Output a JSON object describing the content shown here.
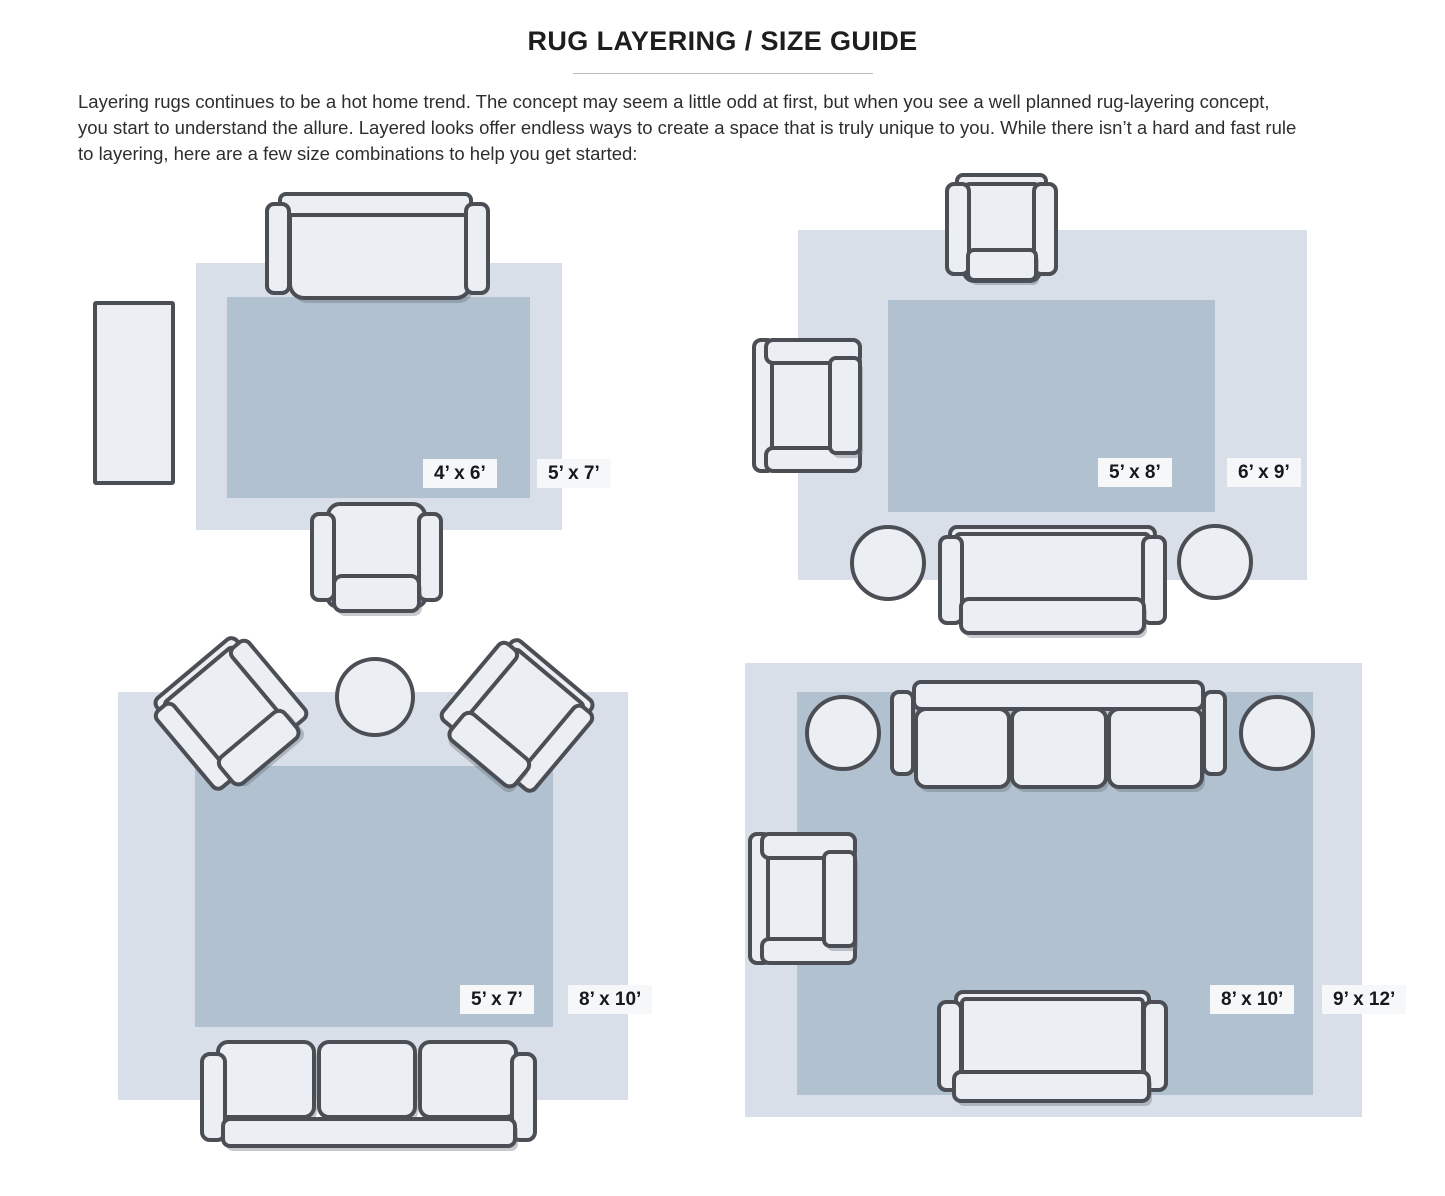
{
  "header": {
    "title": "RUG LAYERING / SIZE GUIDE",
    "intro_lines": [
      "Layering rugs continues to be a hot home trend. The concept may seem a little odd at first, but when you see a well planned rug-layering concept,",
      "you start to understand the allure. Layered looks offer endless ways to create a space that is truly unique to you. While there isn’t a hard and fast rule",
      "to layering, here are a few size combinations to help you get started:"
    ]
  },
  "colors": {
    "rug_outer": "#d9dfe8",
    "rug_inner": "#b2c1d0",
    "furniture_fill": "#ebeef2",
    "furniture_outline": "#4b4f55",
    "label_bg": "#f6f7f9",
    "label_text": "#17181a"
  },
  "diagrams": [
    {
      "id": "top-left",
      "inner_size": "4’ x 6’",
      "outer_size": "5’ x 7’"
    },
    {
      "id": "top-right",
      "inner_size": "5’ x 8’",
      "outer_size": "6’ x 9’"
    },
    {
      "id": "bottom-left",
      "inner_size": "5’ x 7’",
      "outer_size": "8’ x 10’"
    },
    {
      "id": "bottom-right",
      "inner_size": "8’ x 10’",
      "outer_size": "9’ x 12’"
    }
  ]
}
